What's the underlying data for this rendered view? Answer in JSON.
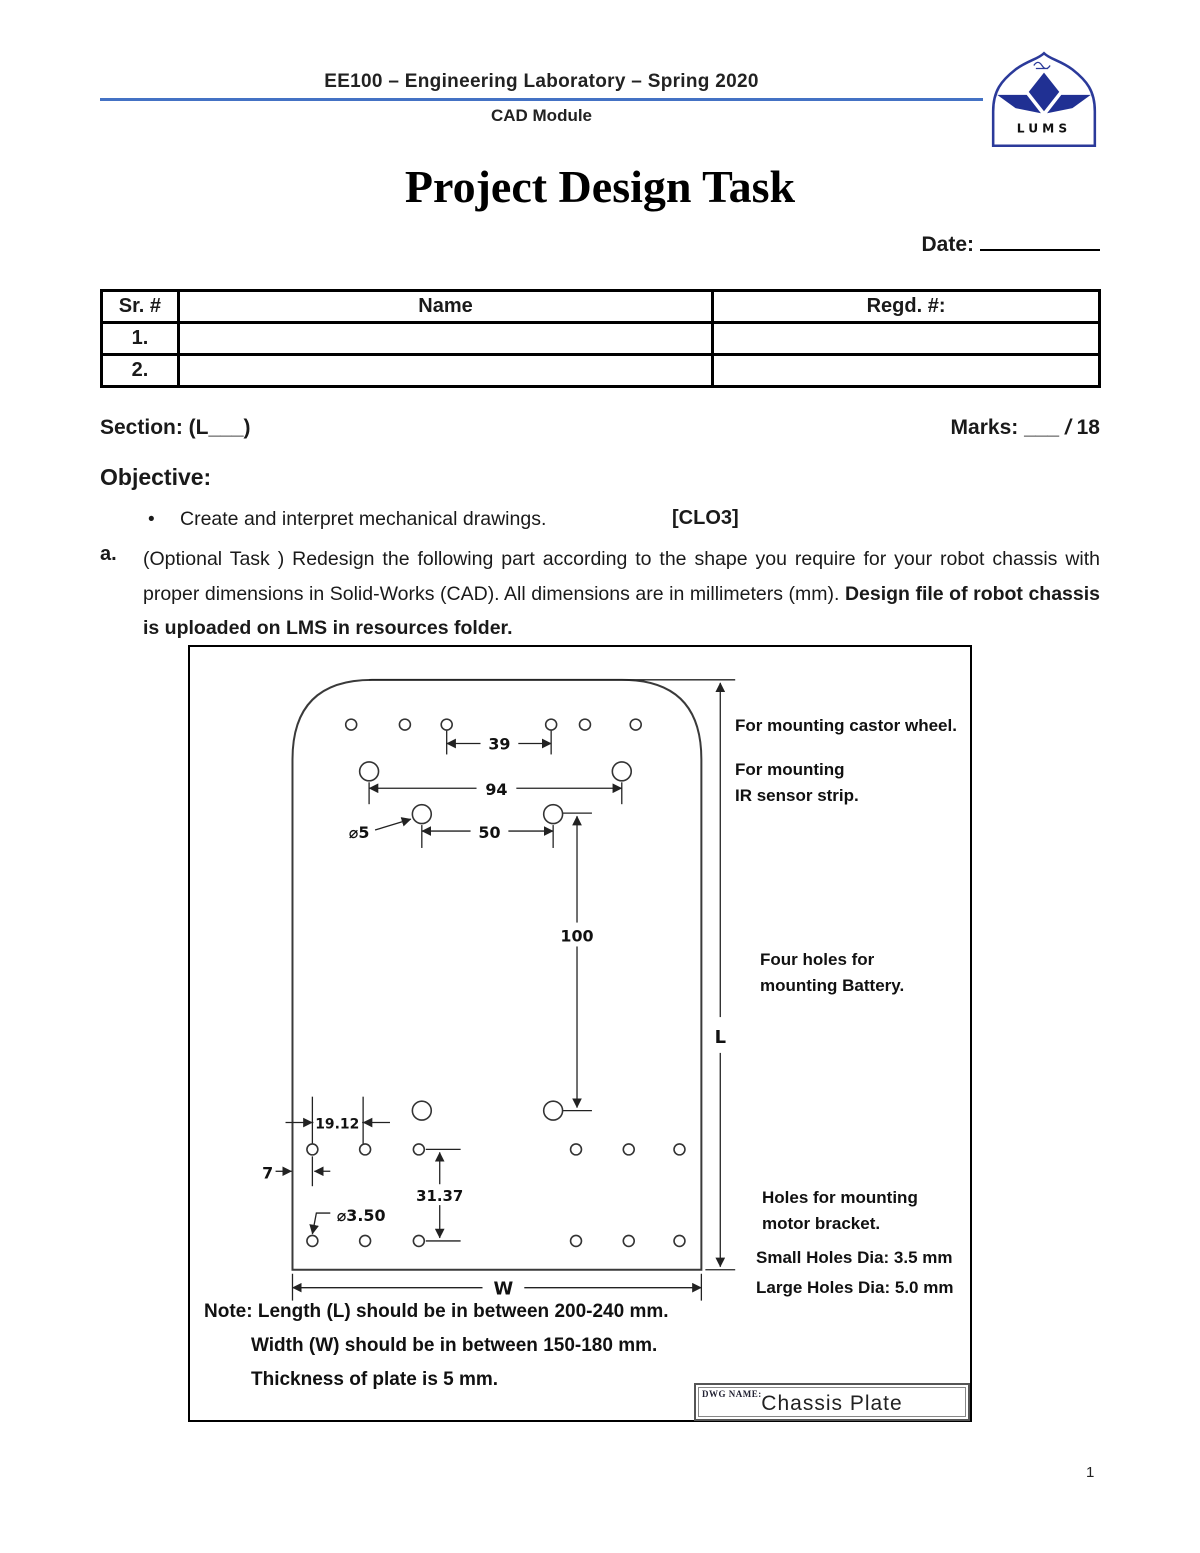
{
  "header": {
    "course": "EE100 – Engineering Laboratory – Spring 2020",
    "module": "CAD Module",
    "logo_text": "LUMS"
  },
  "title": "Project Design Task",
  "date": {
    "label": "Date:"
  },
  "team_table": {
    "col_sr": "Sr. #",
    "col_name": "Name",
    "col_regd": "Regd. #:",
    "rows": [
      {
        "sr": "1.",
        "name": "",
        "regd": ""
      },
      {
        "sr": "2.",
        "name": "",
        "regd": ""
      }
    ]
  },
  "info_row": {
    "section": "Section: (L___)",
    "marks_label": "Marks: ___ ",
    "marks_slash": "/",
    "marks_total": " 18"
  },
  "objective": {
    "heading": "Objective:",
    "bullet_char": "•",
    "text": "Create and interpret mechanical drawings.",
    "clo": "[CLO3]"
  },
  "task": {
    "letter": "a.",
    "text": "(Optional Task ) Redesign the following part according to the shape you require for your robot chassis with proper dimensions in Solid-Works (CAD). All dimensions are in millimeters (mm). ",
    "bold_text": "Design file of robot chassis is uploaded on LMS in resources folder."
  },
  "drawing": {
    "dims": {
      "d39": "39",
      "d94": "94",
      "d50": "50",
      "d100": "100",
      "d19_12": "19.12",
      "d7": "7",
      "d31_37": "31.37",
      "dia5": "⌀5",
      "dia3_5": "⌀3.50",
      "w": "W",
      "l": "L"
    },
    "ann": {
      "castor": "For mounting castor wheel.",
      "ir_1": "For mounting",
      "ir_2": "IR sensor strip.",
      "battery_1": "Four holes for",
      "battery_2": "mounting Battery.",
      "motor_1": "Holes for mounting",
      "motor_2": "motor bracket.",
      "small_holes": "Small Holes Dia: 3.5 mm",
      "large_holes": "Large Holes Dia: 5.0 mm"
    },
    "note": {
      "label": "Note:",
      "line1": "Length (L) should be in between 200-240 mm.",
      "line2": "Width (W) should be in between 150-180 mm.",
      "line3": "Thickness of plate is 5 mm."
    },
    "title_block": {
      "label": "DWG NAME:",
      "name": "Chassis Plate"
    }
  },
  "footer": {
    "page_number": "1"
  }
}
